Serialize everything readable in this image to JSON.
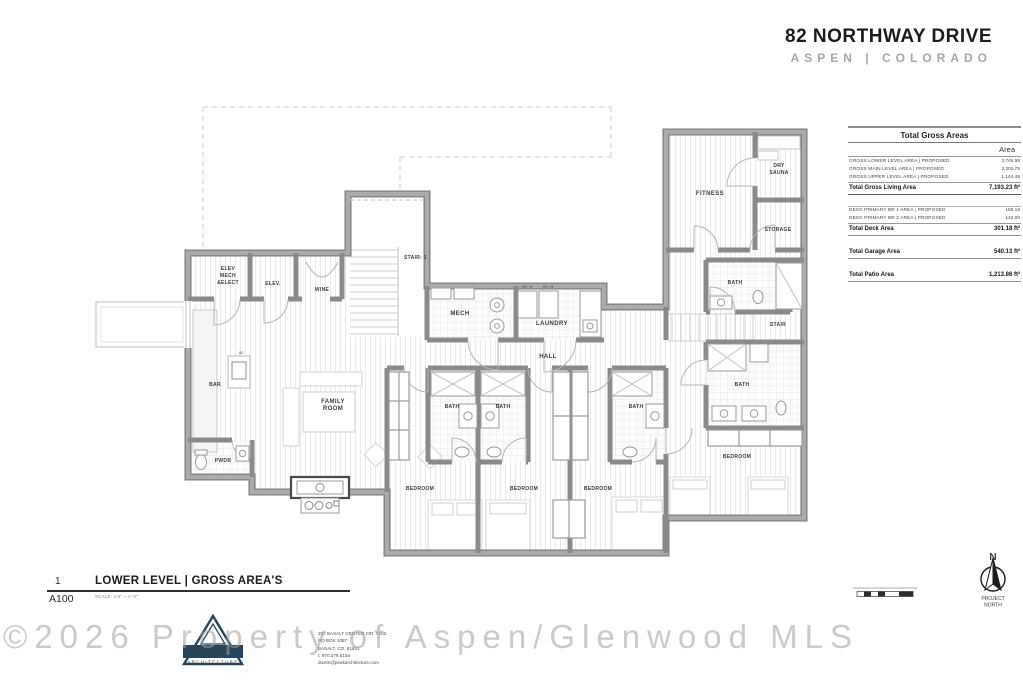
{
  "header": {
    "title": "82 NORTHWAY DRIVE",
    "subtitle": "ASPEN | COLORADO"
  },
  "areas_table": {
    "title": "Total Gross Areas",
    "col_header": "Area",
    "rows": [
      {
        "label": "GROSS LOWER LEVEL AREA | PROPOSED",
        "value": "3,746.99"
      },
      {
        "label": "GROSS MAIN LEVEL AREA | PROPOSED",
        "value": "2,301.75"
      },
      {
        "label": "GROSS UPPER LEVEL AREA | PROPOSED",
        "value": "1,144.49"
      }
    ],
    "total_living": {
      "label": "Total Gross Living Area",
      "value": "7,193.23 ft²"
    },
    "deck_rows": [
      {
        "label": "DECK PRIMARY BR 1 AREA | PROPOSED",
        "value": "159.18"
      },
      {
        "label": "DECK PRIMARY BR 2 AREA | PROPOSED",
        "value": "142.00"
      }
    ],
    "total_deck": {
      "label": "Total Deck Area",
      "value": "301.18 ft²"
    },
    "total_garage": {
      "label": "Total Garage Area",
      "value": "540.13 ft²"
    },
    "total_patio": {
      "label": "Total Patio Area",
      "value": "1,213.86 ft²"
    }
  },
  "plan": {
    "rooms": {
      "elev_mech_1": "ELEV",
      "elev_mech_2": "MECH",
      "elev_mech_3": "&ELECT",
      "elev": "ELEV.",
      "wine": "WINE",
      "stair1": "STAIR: 1",
      "mech": "MECH",
      "laundry": "LAUNDRY",
      "hall": "HALL",
      "family_1": "FAMILY",
      "family_2": "ROOM",
      "bar": "BAR",
      "pwdr": "PWDR",
      "bath": "BATH",
      "bedroom": "BEDROOM",
      "fitness": "FITNESS",
      "sauna_1": "DRY",
      "sauna_2": "SAUNA",
      "storage": "STORAGE",
      "stair2": "STAIR",
      "uc": "UC",
      "drw": "DR / W"
    }
  },
  "title_block": {
    "number": "1",
    "sheet": "A100",
    "title": "LOWER LEVEL | GROSS AREA'S",
    "scale": "SCALE: 1/4\" = 1'-0\""
  },
  "north": {
    "n": "N",
    "line1": "PROJECT",
    "line2": "NORTH"
  },
  "watermark": "©2026 Property of Aspen/Glenwood MLS",
  "logo": {
    "name": "PEAK",
    "sub": "ARCHITECTURE"
  },
  "firm": {
    "lines": [
      "207 BASALT CENTER CIR. #102",
      "PO BOX 1087",
      "BASALT, CO. 81621",
      "t: 970.279.5154",
      "dustin@peakarchitecture.com"
    ]
  },
  "colors": {
    "logo_navy": "#24455e",
    "wall_gray": "#9b9b9b",
    "watermark_gray": "#c6c6c6",
    "dashed_gray": "#d7d7d7"
  }
}
